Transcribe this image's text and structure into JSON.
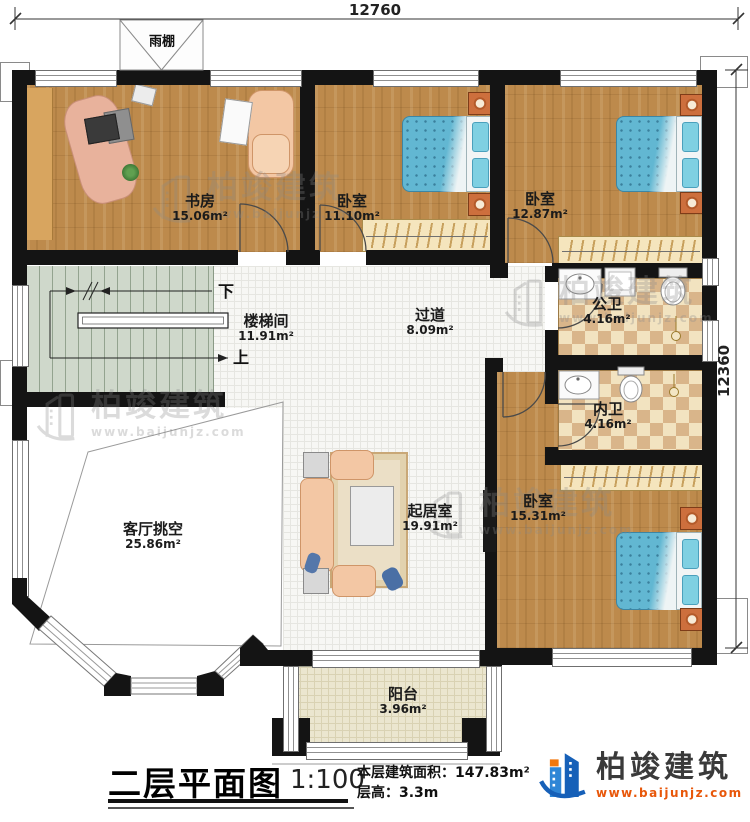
{
  "dimensions": {
    "top": "12760",
    "right": "12360"
  },
  "canopy": {
    "label": "雨棚"
  },
  "rooms": [
    {
      "id": "study",
      "name": "书房",
      "area": "15.06m²"
    },
    {
      "id": "bedroom1",
      "name": "卧室",
      "area": "11.10m²"
    },
    {
      "id": "bedroom2",
      "name": "卧室",
      "area": "12.87m²"
    },
    {
      "id": "stairwell",
      "name": "楼梯间",
      "area": "11.91m²"
    },
    {
      "id": "hallway",
      "name": "过道",
      "area": "8.09m²"
    },
    {
      "id": "public-bath",
      "name": "公卫",
      "area": "4.16m²"
    },
    {
      "id": "ensuite-bath",
      "name": "内卫",
      "area": "4.16m²"
    },
    {
      "id": "living-void",
      "name": "客厅挑空",
      "area": "25.86m²"
    },
    {
      "id": "living-room",
      "name": "起居室",
      "area": "19.91m²"
    },
    {
      "id": "bedroom3",
      "name": "卧室",
      "area": "15.31m²"
    },
    {
      "id": "balcony",
      "name": "阳台",
      "area": "3.96m²"
    }
  ],
  "stairs": {
    "down": "下",
    "up": "上"
  },
  "watermark": {
    "brand": "柏竣建筑",
    "url": "www.baijunjz.com"
  },
  "logo": {
    "brand": "柏竣建筑",
    "url": "www.baijunjz.com"
  },
  "title_block": {
    "title": "二层平面图",
    "scale": "1:100",
    "area_label": "本层建筑面积：",
    "area_value": "147.83m²",
    "floor_height_label": "层高：",
    "floor_height_value": "3.3m"
  },
  "colors": {
    "wall": "#141414",
    "wood": "#bd8a4c",
    "bed_blue": "#62b7d2",
    "logo_blue": "#1660b8",
    "accent_orange": "#e8570a"
  }
}
